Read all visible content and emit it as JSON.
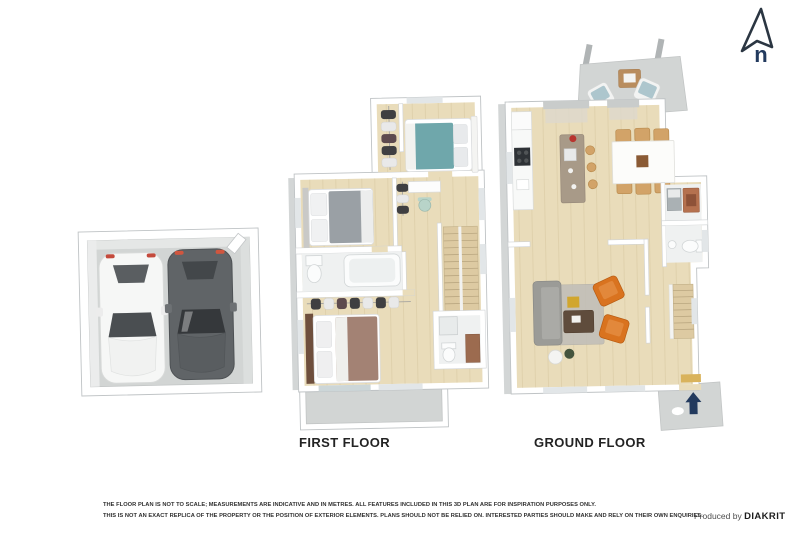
{
  "compass": {
    "letter": "n"
  },
  "plans": {
    "first_floor": {
      "label": "FIRST FLOOR"
    },
    "ground_floor": {
      "label": "GROUND FLOOR"
    }
  },
  "footer": {
    "disclaimer_line1": "THE FLOOR PLAN IS NOT TO SCALE; MEASUREMENTS ARE INDICATIVE AND IN METRES. ALL FEATURES INCLUDED IN THIS 3D PLAN ARE FOR INSPIRATION PURPOSES ONLY.",
    "disclaimer_line2": "THIS IS NOT AN EXACT REPLICA OF THE PROPERTY OR THE POSITION OF EXTERIOR ELEMENTS. PLANS SHOULD NOT BE RELIED ON. INTERESTED PARTIES SHOULD MAKE AND RELY ON THEIR OWN ENQUIRIES.",
    "produced_by": "Produced by",
    "brand": "DIAKRIT"
  },
  "colors": {
    "floor_wood": "#e9dcba",
    "floor_concrete": "#d2d5d4",
    "wall_white": "#ffffff",
    "wall_stroke": "#bfc3c5",
    "bed_teal": "#6fa7ab",
    "bed_gray": "#9aa0a5",
    "bed_brown": "#a38274",
    "armchair_orange": "#d9731f",
    "sofa_gray": "#9b9b97",
    "stool_wood": "#d2a368",
    "navy": "#223a5e",
    "car_white": "#f6f7f6",
    "car_dark": "#606467",
    "text_dark": "#232323"
  }
}
